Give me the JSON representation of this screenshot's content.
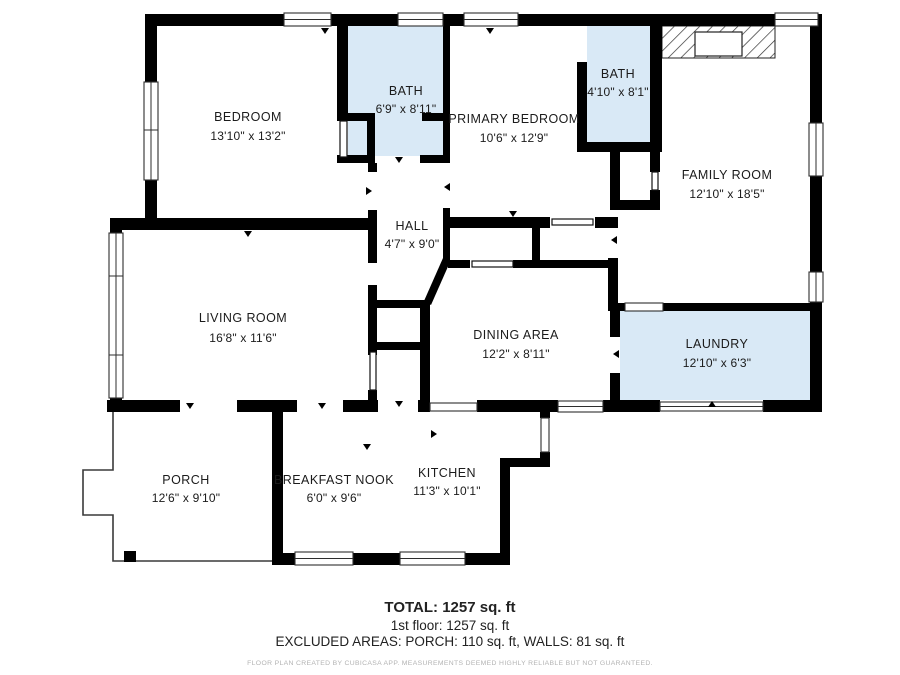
{
  "plan": {
    "rooms": [
      {
        "id": "bedroom",
        "name": "BEDROOM",
        "dims": "13'10\" x 13'2\""
      },
      {
        "id": "bath-upper",
        "name": "BATH",
        "dims": "6'9\" x 8'11\""
      },
      {
        "id": "primary-bedroom",
        "name": "PRIMARY BEDROOM",
        "dims": "10'6\" x 12'9\""
      },
      {
        "id": "bath-right",
        "name": "BATH",
        "dims": "4'10\" x 8'1\""
      },
      {
        "id": "family-room",
        "name": "FAMILY ROOM",
        "dims": "12'10\" x 18'5\""
      },
      {
        "id": "hall",
        "name": "HALL",
        "dims": "4'7\" x 9'0\""
      },
      {
        "id": "living-room",
        "name": "LIVING ROOM",
        "dims": "16'8\" x 11'6\""
      },
      {
        "id": "dining-area",
        "name": "DINING AREA",
        "dims": "12'2\" x 8'11\""
      },
      {
        "id": "laundry",
        "name": "LAUNDRY",
        "dims": "12'10\" x 6'3\""
      },
      {
        "id": "porch",
        "name": "PORCH",
        "dims": "12'6\" x 9'10\""
      },
      {
        "id": "breakfast-nook",
        "name": "BREAKFAST NOOK",
        "dims": "6'0\" x 9'6\""
      },
      {
        "id": "kitchen",
        "name": "KITCHEN",
        "dims": "11'3\" x 10'1\""
      }
    ],
    "colors": {
      "wet_room_fill": "#d9e9f6",
      "wall": "#000000"
    }
  },
  "footer": {
    "total": "TOTAL: 1257 sq. ft",
    "first_floor": "1st floor: 1257 sq. ft",
    "excluded": "EXCLUDED AREAS: PORCH: 110 sq. ft, WALLS: 81 sq. ft",
    "disclaimer": "FLOOR PLAN CREATED BY CUBICASA APP. MEASUREMENTS DEEMED HIGHLY RELIABLE BUT NOT GUARANTEED."
  }
}
